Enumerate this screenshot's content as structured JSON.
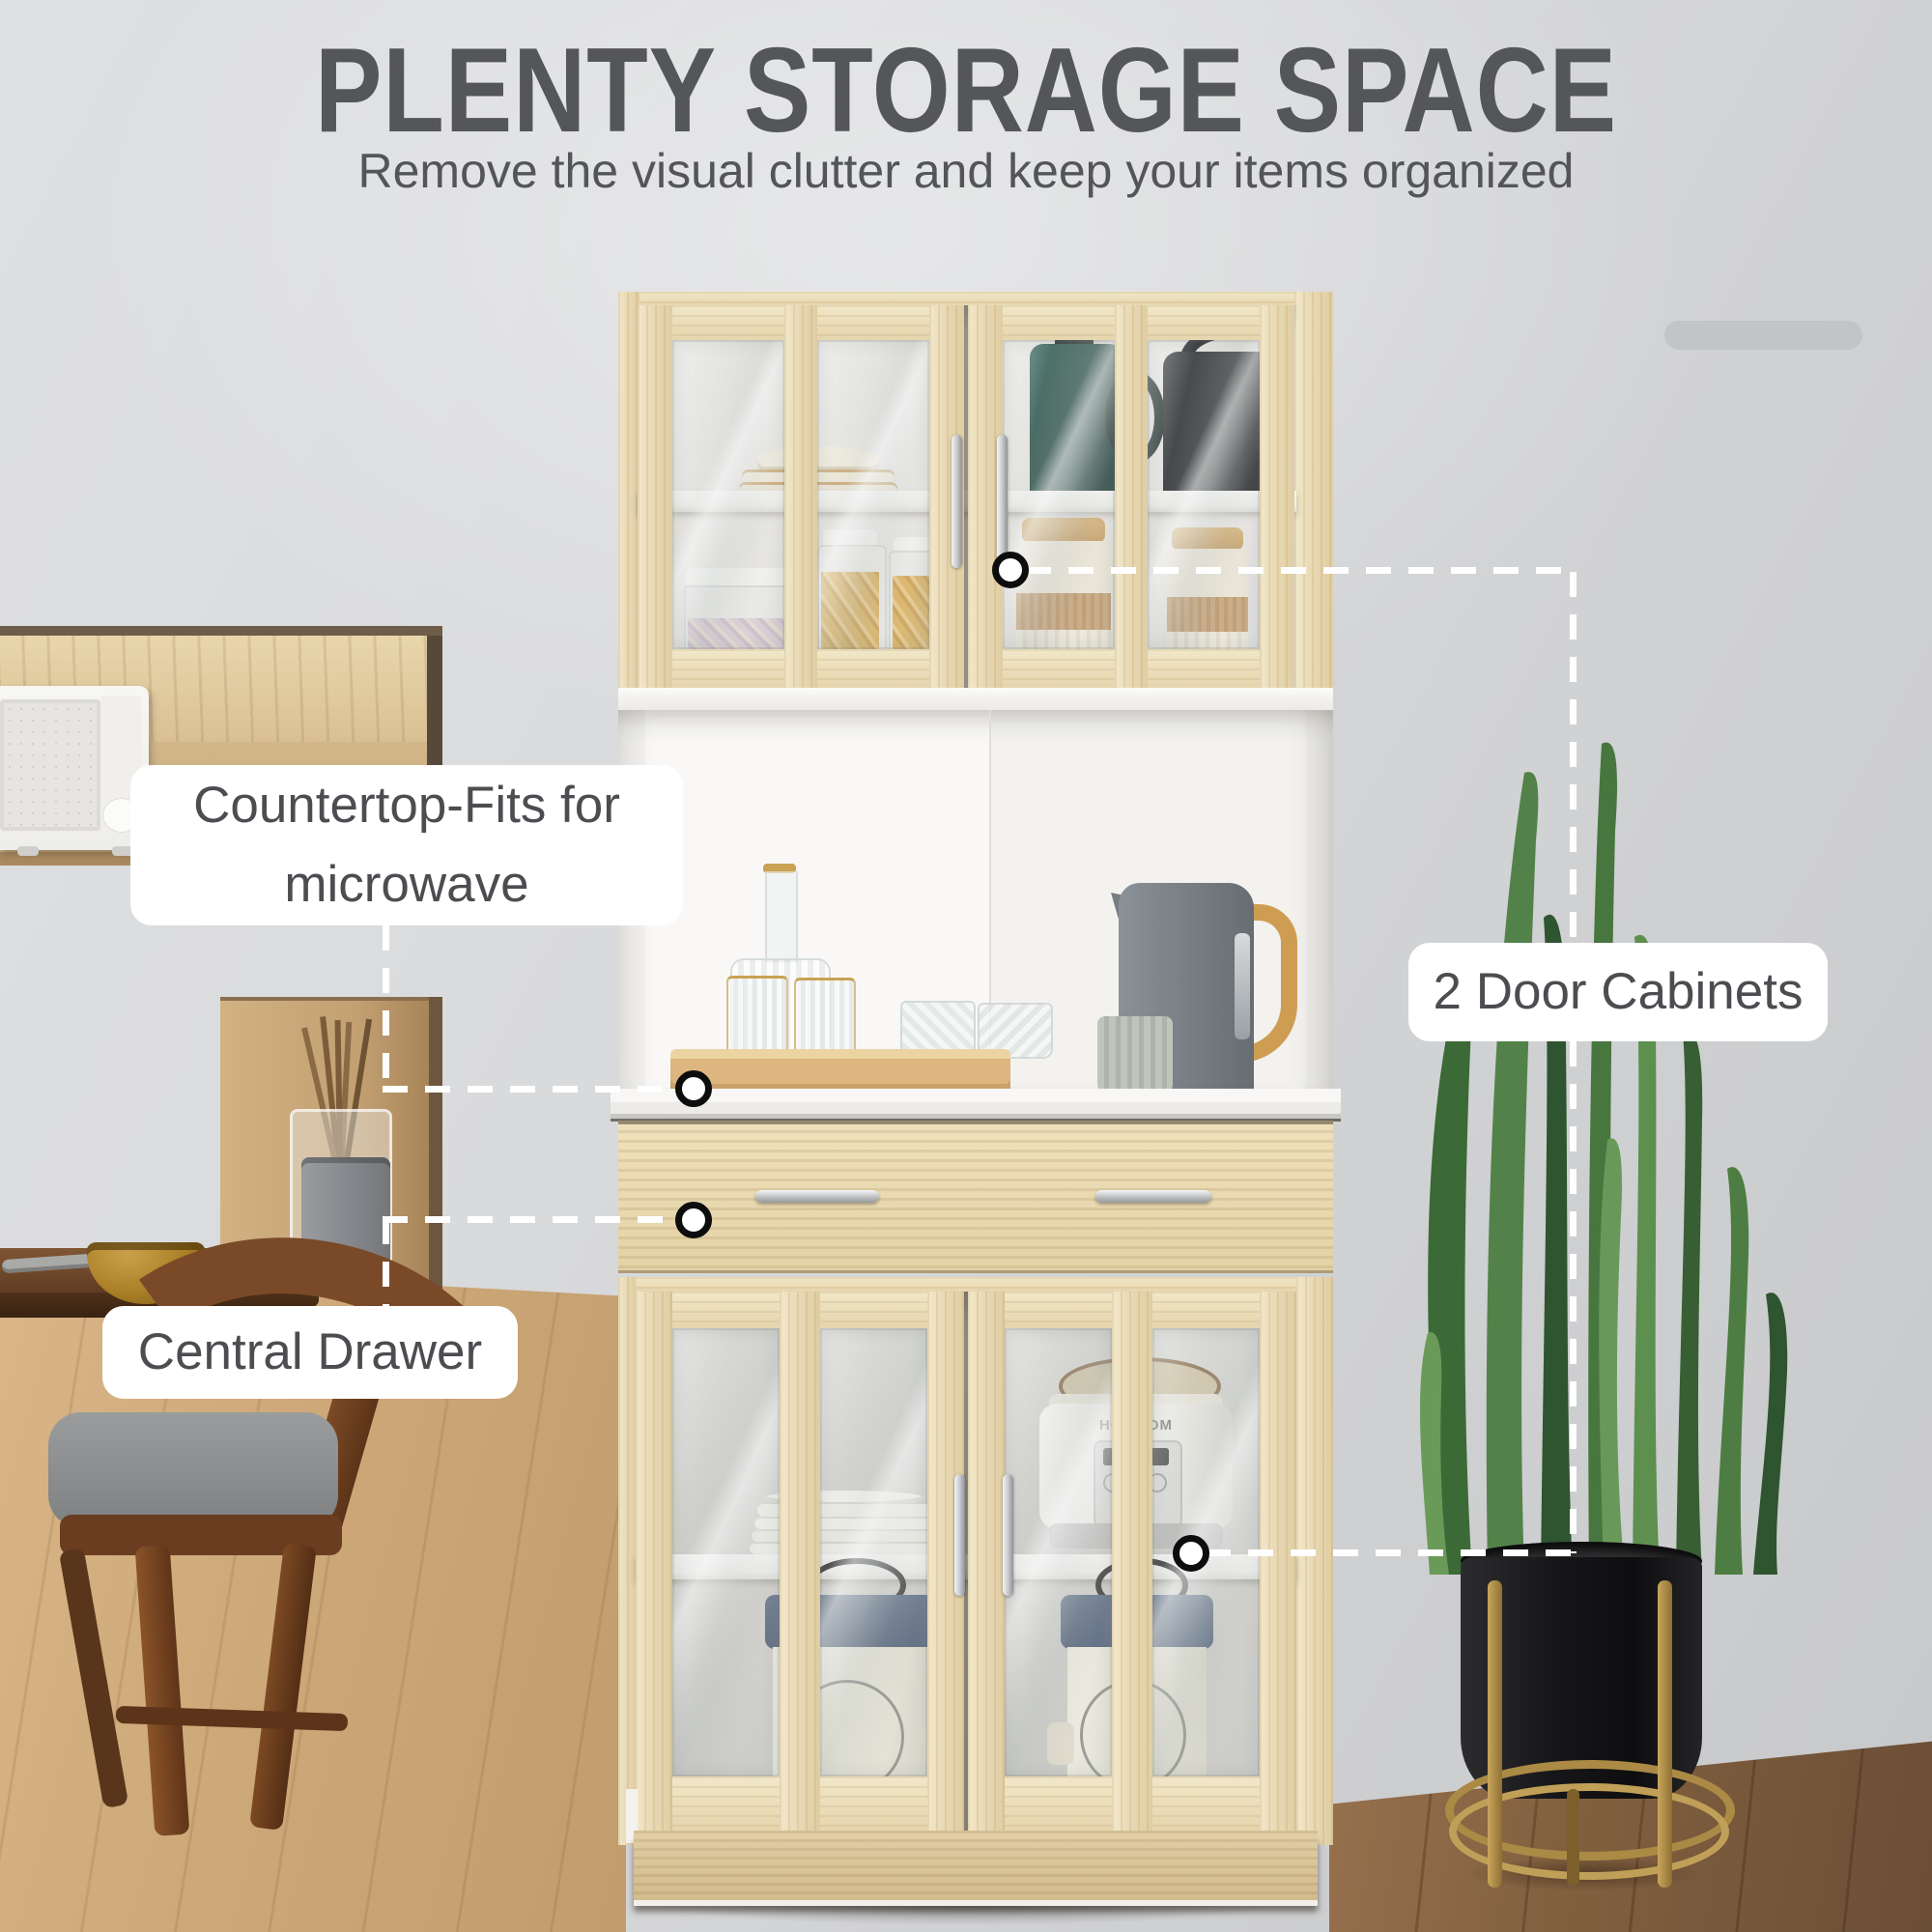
{
  "header": {
    "title": "PLENTY STORAGE SPACE",
    "subtitle": "Remove the visual clutter and keep your items organized"
  },
  "callouts": {
    "countertop": {
      "label": "Countertop-Fits for microwave"
    },
    "door_cabinets": {
      "label": "2 Door Cabinets"
    },
    "central_drawer": {
      "label": "Central Drawer"
    }
  },
  "products": {
    "cooker_logo": "HOMCOM"
  },
  "colors": {
    "title_text": "#55565a",
    "subtitle_text": "#54555a",
    "label_text": "#4c4d51",
    "label_bg": "#ffffff",
    "decor_bar": "#c2c5c8",
    "dash": "#ffffff",
    "marker_ring": "#0d0d0d",
    "wood": "#eadfbd",
    "white_panel": "#f7f6f4",
    "glass_tint": "#cdd4d2",
    "teal_pot": "#1e443e",
    "kettle_black": "#1a1c1e",
    "kettle_gray": "#798086",
    "handle_wood": "#cf9d52",
    "bin_navy": "#4a5a72",
    "bin_cream": "#ebe7d9",
    "bowl_mustard": "#b5882f",
    "chair_walnut": "#7a4a28",
    "cushion_gray": "#8e9092",
    "pot_black": "#1d1d1f",
    "stand_gold": "#b2914d",
    "leaf_green": "#4d7d42"
  }
}
